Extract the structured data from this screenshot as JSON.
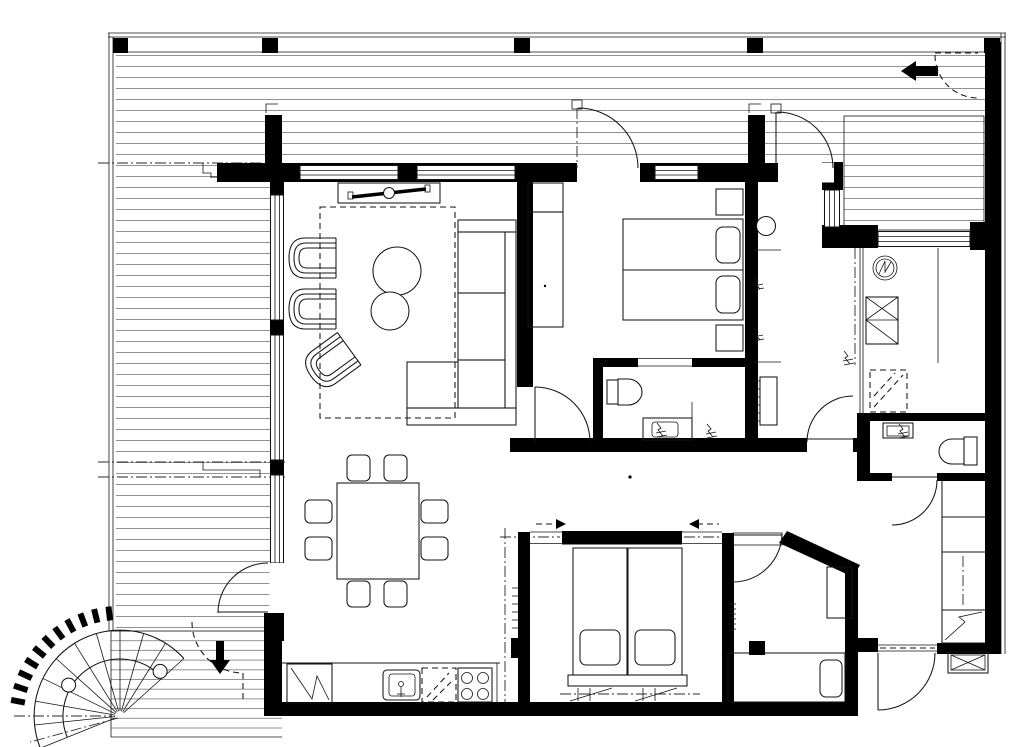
{
  "page": {
    "background": "#ffffff"
  },
  "palette": {
    "bg": "#ffffff",
    "wall": "#000000",
    "line": "#141414",
    "dash": "#2a2a2a",
    "deck": "#777777"
  },
  "plan": {
    "type": "apartment floor plan",
    "rooms": [
      {
        "name": "terrace"
      },
      {
        "name": "living-room"
      },
      {
        "name": "dining-area"
      },
      {
        "name": "kitchen"
      },
      {
        "name": "bedroom-1"
      },
      {
        "name": "ensuite-bathroom"
      },
      {
        "name": "shower-room"
      },
      {
        "name": "utility-room"
      },
      {
        "name": "wc"
      },
      {
        "name": "hallway"
      },
      {
        "name": "bedroom-2"
      },
      {
        "name": "bedroom-3"
      },
      {
        "name": "entry-porch"
      }
    ],
    "fixtures": [
      {
        "name": "corner-sofa"
      },
      {
        "name": "armchair",
        "count": 3
      },
      {
        "name": "coffee-table",
        "count": 2
      },
      {
        "name": "tv-console"
      },
      {
        "name": "dining-table"
      },
      {
        "name": "dining-chair",
        "count": 8
      },
      {
        "name": "fridge"
      },
      {
        "name": "kitchen-sink"
      },
      {
        "name": "dishwasher"
      },
      {
        "name": "cooktop-4-burners"
      },
      {
        "name": "double-bed",
        "count": 2
      },
      {
        "name": "single-bed"
      },
      {
        "name": "wardrobe",
        "count": 2
      },
      {
        "name": "nightstand",
        "count": 2
      },
      {
        "name": "toilet",
        "count": 3
      },
      {
        "name": "washbasin",
        "count": 3
      },
      {
        "name": "radiator",
        "count": 2
      },
      {
        "name": "water-heater"
      },
      {
        "name": "electrical-symbol"
      },
      {
        "name": "shower-dashed"
      },
      {
        "name": "closet-column-4-cells"
      },
      {
        "name": "spiral-stair"
      },
      {
        "name": "ventilation-shaft"
      }
    ],
    "entry_arrows": [
      {
        "name": "terrace-entry-arrow",
        "direction": "left"
      },
      {
        "name": "stair-entry-arrow",
        "direction": "down"
      }
    ],
    "sliding_door_arrows": [
      {
        "direction": "right"
      },
      {
        "direction": "left"
      }
    ]
  }
}
